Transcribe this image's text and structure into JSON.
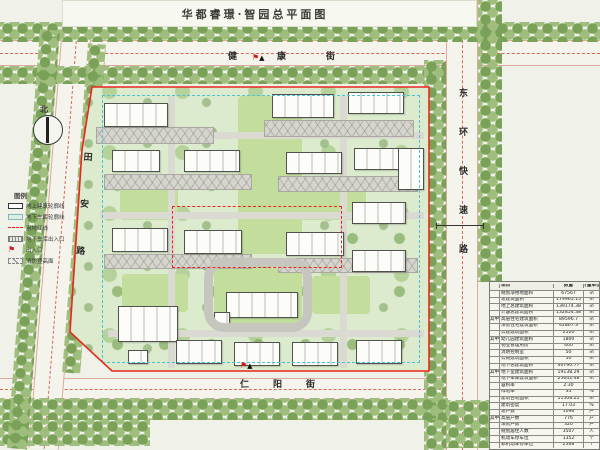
{
  "title": "华都睿璟·智园总平面图",
  "compass": {
    "label": "北"
  },
  "streets": {
    "top": "健康街",
    "right": "东环快速路",
    "left": "田安路",
    "bottom": "仁阳街"
  },
  "colors": {
    "boundary_red": "#e8281c",
    "garage_cyan": "#4cc3d4",
    "tree_green_dark": "#7aa158",
    "tree_green_light": "#9fbe7d",
    "site_green": "#dcebcd",
    "paper": "#f0f1e9"
  },
  "legend": {
    "title": "图例",
    "items": [
      {
        "icon": "lg-building",
        "icon_name": "building-outline-icon",
        "label": "地上建筑轮廓线"
      },
      {
        "icon": "lg-garage",
        "icon_name": "garage-outline-icon",
        "label": "地下车库轮廓线"
      },
      {
        "icon": "lg-redline",
        "icon_name": "red-boundary-icon",
        "label": "用地红线"
      },
      {
        "icon": "lg-ramp",
        "icon_name": "garage-ramp-icon",
        "label": "地下车库出入口"
      },
      {
        "icon": "lg-flag",
        "icon_name": "entrance-flag-icon",
        "label": "出入口",
        "glyph": "⚑"
      },
      {
        "icon": "lg-pad",
        "icon_name": "fire-pad-icon",
        "label": "消防登高面"
      }
    ]
  },
  "entrances": [
    {
      "x": 252,
      "y": 54
    },
    {
      "x": 240,
      "y": 362
    }
  ],
  "entrance_glyphs": {
    "flag": "⚑",
    "arrow": "▲"
  },
  "site": {
    "lawns": [
      {
        "x": 238,
        "y": 96,
        "w": 64,
        "h": 158
      },
      {
        "x": 120,
        "y": 186,
        "w": 58,
        "h": 34
      },
      {
        "x": 300,
        "y": 186,
        "w": 66,
        "h": 34
      },
      {
        "x": 122,
        "y": 274,
        "w": 66,
        "h": 38
      },
      {
        "x": 312,
        "y": 276,
        "w": 58,
        "h": 38
      },
      {
        "x": 214,
        "y": 268,
        "w": 88,
        "h": 56
      }
    ],
    "roads": [
      {
        "x": 168,
        "y": 96,
        "w": 7,
        "h": 272
      },
      {
        "x": 340,
        "y": 96,
        "w": 7,
        "h": 272
      },
      {
        "x": 100,
        "y": 132,
        "w": 324,
        "h": 7
      },
      {
        "x": 100,
        "y": 212,
        "w": 324,
        "h": 7
      },
      {
        "x": 108,
        "y": 330,
        "w": 316,
        "h": 7
      }
    ],
    "fire_pads": [
      {
        "x": 96,
        "y": 127,
        "w": 118,
        "h": 17
      },
      {
        "x": 264,
        "y": 120,
        "w": 150,
        "h": 17
      },
      {
        "x": 104,
        "y": 174,
        "w": 148,
        "h": 16
      },
      {
        "x": 278,
        "y": 176,
        "w": 140,
        "h": 16
      },
      {
        "x": 104,
        "y": 254,
        "w": 148,
        "h": 15
      },
      {
        "x": 278,
        "y": 258,
        "w": 140,
        "h": 15
      }
    ],
    "buildings": [
      {
        "x": 104,
        "y": 103,
        "w": 64,
        "h": 24
      },
      {
        "x": 272,
        "y": 94,
        "w": 62,
        "h": 24
      },
      {
        "x": 348,
        "y": 92,
        "w": 56,
        "h": 22
      },
      {
        "x": 112,
        "y": 150,
        "w": 48,
        "h": 22
      },
      {
        "x": 184,
        "y": 150,
        "w": 56,
        "h": 22
      },
      {
        "x": 286,
        "y": 152,
        "w": 56,
        "h": 22
      },
      {
        "x": 354,
        "y": 148,
        "w": 54,
        "h": 22
      },
      {
        "x": 112,
        "y": 228,
        "w": 56,
        "h": 24
      },
      {
        "x": 184,
        "y": 230,
        "w": 58,
        "h": 24
      },
      {
        "x": 286,
        "y": 232,
        "w": 58,
        "h": 24
      },
      {
        "x": 352,
        "y": 202,
        "w": 54,
        "h": 22
      },
      {
        "x": 352,
        "y": 250,
        "w": 54,
        "h": 22
      },
      {
        "x": 398,
        "y": 148,
        "w": 26,
        "h": 42
      },
      {
        "x": 226,
        "y": 292,
        "w": 72,
        "h": 26
      },
      {
        "x": 118,
        "y": 306,
        "w": 60,
        "h": 36
      },
      {
        "x": 176,
        "y": 340,
        "w": 46,
        "h": 24
      },
      {
        "x": 234,
        "y": 342,
        "w": 46,
        "h": 24
      },
      {
        "x": 292,
        "y": 342,
        "w": 46,
        "h": 24
      },
      {
        "x": 356,
        "y": 340,
        "w": 46,
        "h": 24
      },
      {
        "x": 214,
        "y": 312,
        "w": 16,
        "h": 12
      },
      {
        "x": 128,
        "y": 350,
        "w": 20,
        "h": 14
      }
    ]
  },
  "landscape": {
    "tree_bands": [
      {
        "x": 0,
        "y": 22,
        "w": 600,
        "h": 20
      },
      {
        "x": 0,
        "y": 66,
        "w": 446,
        "h": 18
      },
      {
        "x": 424,
        "y": 60,
        "w": 22,
        "h": 390
      },
      {
        "x": 478,
        "y": 0,
        "w": 24,
        "h": 282
      },
      {
        "x": 0,
        "y": 398,
        "w": 448,
        "h": 22
      },
      {
        "x": 0,
        "y": 420,
        "w": 150,
        "h": 26
      },
      {
        "x": 446,
        "y": 400,
        "w": 44,
        "h": 48
      },
      {
        "x": 40,
        "y": 30,
        "w": 20,
        "h": 420,
        "rot": 4.5
      },
      {
        "x": 88,
        "y": 44,
        "w": 18,
        "h": 330,
        "rot": 4.5
      }
    ]
  },
  "table": {
    "headers": [
      "项目",
      "数量",
      "计量单位"
    ],
    "unit_sqm": "㎡",
    "rows": [
      {
        "group": "",
        "label": "规划净用地面积",
        "value": "67567",
        "unit": "㎡"
      },
      {
        "group": "",
        "label": "总建筑面积",
        "value": "179965.15",
        "unit": "㎡"
      },
      {
        "group": "",
        "label": "地上总建筑面积",
        "value": "139174.38",
        "unit": "㎡"
      },
      {
        "group": "",
        "label": "计容总建筑面积",
        "value": "132854.38",
        "unit": "㎡"
      },
      {
        "group": "其中",
        "label": "高层住宅建筑面积",
        "value": "89596.7",
        "unit": "㎡"
      },
      {
        "group": "",
        "label": "洋房住宅建筑面积",
        "value": "42867.3",
        "unit": "㎡"
      },
      {
        "group": "",
        "label": "公建建筑面积",
        "value": "2520",
        "unit": "㎡"
      },
      {
        "group": "其中",
        "label": "幼儿园建筑面积",
        "value": "1800",
        "unit": "㎡"
      },
      {
        "group": "",
        "label": "物业管理用房",
        "value": "400",
        "unit": "㎡"
      },
      {
        "group": "",
        "label": "消防控制室",
        "value": "50",
        "unit": "㎡"
      },
      {
        "group": "",
        "label": "公厕建筑面积",
        "value": "50",
        "unit": "㎡"
      },
      {
        "group": "",
        "label": "地下总建筑面积",
        "value": "40790.77",
        "unit": "㎡"
      },
      {
        "group": "其中",
        "label": "地下室建筑面积",
        "value": "19138.29",
        "unit": "㎡"
      },
      {
        "group": "",
        "label": "地下车库建筑面积",
        "value": "25642.48",
        "unit": "㎡"
      },
      {
        "group": "",
        "label": "容积率",
        "value": "2.30",
        "unit": ""
      },
      {
        "group": "",
        "label": "绿地率",
        "value": "35",
        "unit": "%"
      },
      {
        "group": "",
        "label": "建筑占地面积",
        "value": "11508.21",
        "unit": "㎡"
      },
      {
        "group": "",
        "label": "建筑密度",
        "value": "17.03",
        "unit": "%"
      },
      {
        "group": "",
        "label": "总户数",
        "value": "1096",
        "unit": "户"
      },
      {
        "group": "其中",
        "label": "高层户数",
        "value": "776",
        "unit": "户"
      },
      {
        "group": "",
        "label": "洋房户数",
        "value": "320",
        "unit": "户"
      },
      {
        "group": "",
        "label": "规划居住人数",
        "value": "3507",
        "unit": "人"
      },
      {
        "group": "",
        "label": "机动车停车位",
        "value": "1352",
        "unit": "个"
      },
      {
        "group": "",
        "label": "非机动车停车位",
        "value": "2368",
        "unit": "个"
      }
    ]
  }
}
